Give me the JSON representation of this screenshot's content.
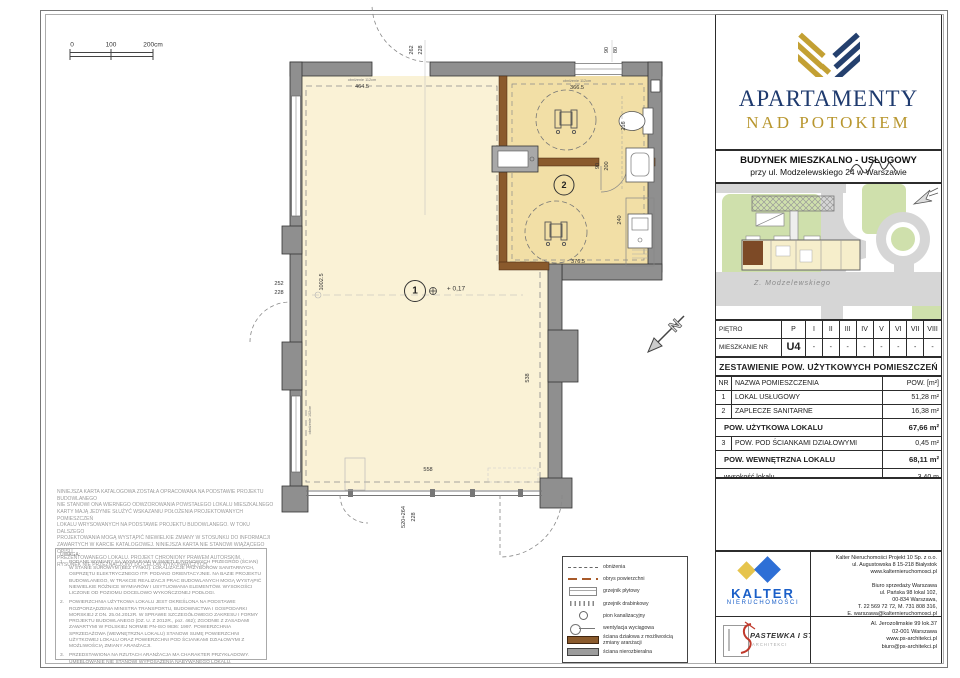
{
  "brand": {
    "line1": "APARTAMENTY",
    "line2": "NAD POTOKIEM"
  },
  "building": {
    "line1": "BUDYNEK MIESZKALNO - USŁUGOWY",
    "line2": "przy ul. Modzelewskiego 24 w Warszawie"
  },
  "site_map": {
    "street": "Z. Modzelewskiego"
  },
  "floor_table": {
    "row1_label": "PIĘTRO",
    "row2_label": "MIESZKANIE NR",
    "cols": [
      "P",
      "I",
      "II",
      "III",
      "IV",
      "V",
      "VI",
      "VII",
      "VIII"
    ],
    "vals": [
      "U4",
      "-",
      "-",
      "-",
      "-",
      "-",
      "-",
      "-",
      "-"
    ]
  },
  "area_table": {
    "title": "ZESTAWIENIE POW. UŻYTKOWYCH POMIESZCZEŃ",
    "col_nr": "NR",
    "col_name": "NAZWA POMIESZCZENIA",
    "col_area": "POW. [m²]",
    "rows": [
      {
        "nr": "1",
        "name": "LOKAL USŁUGOWY",
        "area": "51,28 m²"
      },
      {
        "nr": "2",
        "name": "ZAPLECZE SANITARNE",
        "area": "16,38 m²"
      }
    ],
    "sum1_label": "POW. UŻYTKOWA LOKALU",
    "sum1_value": "67,66 m²",
    "row3": {
      "nr": "3",
      "name": "POW. POD ŚCIANKAMI DZIAŁOWYMI",
      "area": "0,45 m²"
    },
    "sum2_label": "POW. WEWNĘTRZNA LOKALU",
    "sum2_value": "68,11 m²",
    "height_label": "wysokość  lokalu",
    "height_value": "3,40 m"
  },
  "plan": {
    "scale": {
      "s0": "0",
      "s100": "100",
      "s200": "200cm"
    },
    "room1": {
      "number": "1",
      "level": "+ 0,17"
    },
    "room2": {
      "number": "2"
    },
    "north": "N",
    "dims": {
      "t464": "464.5",
      "t366": "366.5",
      "ob112a": "obniżenie 112cm",
      "ob112b": "obniżenie 112cm",
      "ob102": "obniżenie 102cm",
      "d262": "262",
      "d228a": "228",
      "d90a": "90",
      "d80": "80",
      "l252": "252",
      "l228": "228",
      "v1002": "1002.5",
      "v538": "538",
      "d376": "376.5",
      "d216": "216",
      "d240": "240",
      "d90b": "90",
      "d200": "200",
      "b558": "558",
      "b520": "520+264",
      "b228": "228"
    }
  },
  "legend": {
    "items": [
      {
        "symbol": "dashed-gray-line",
        "label": "obniżenia"
      },
      {
        "symbol": "dashed-red-line",
        "label": "obrys powierzchni"
      },
      {
        "symbol": "panel-radiator",
        "label": "grzejnik płytowy"
      },
      {
        "symbol": "ladder-radiator",
        "label": "grzejnik drabinkowy"
      },
      {
        "symbol": "circle",
        "label": "pion kanalizacyjny"
      },
      {
        "symbol": "vent",
        "label": "wentylacja wyciągowa"
      },
      {
        "symbol": "brown-bar",
        "label": "ściana działowa z możliwością zmiany aranżacji"
      },
      {
        "symbol": "gray-bar",
        "label": "ściana nierozbieralna"
      }
    ]
  },
  "kalter": {
    "name": "KALTER",
    "subtitle": "NIERUCHOMOŚCI"
  },
  "architect": {
    "name": "PASTEWKA I STRÓJ",
    "subtitle": "ARCHITEKCI"
  },
  "contacts": {
    "kalter_hq": "Kalter Nieruchomości Projekt 10 Sp. z o.o.\nul. Augustowska 8 15-218 Białystok\nwww.kalternieruchomosci.pl",
    "kalter_office": "Biuro sprzedaży Warszawa\nul. Pańska 98 lokal 102,\n00-834 Warszawa,\nT. 22 569 72 72, M. 731 808 316,\nE. warszawa@kalternieruchomosci.pl",
    "architect_office": "Al. Jerozolimskie 99 lok.37\n02-001 Warszawa\nwww.ps-architekci.pl\nbiuro@ps-architekci.pl"
  },
  "disclaimer": "NINIEJSZA KARTA KATALOGOWA ZOSTAŁA OPRACOWANA NA PODSTAWIE PROJEKTU BUDOWLANEGO\nNIE STANOWI ONA WIERNEGO ODWZOROWANIA POWSTAŁEGO LOKALU MIESZKALNEGO\nKARTY MAJĄ JEDYNIE SŁUŻYĆ WSKAZANIU POŁOŻENIA PROJEKTOWANYCH POMIESZCZEŃ\nLOKALU WRYSOWANYCH NA PODSTAWIE PROJEKTU BUDOWLANEGO. W TOKU DALSZEGO\nPROJEKTOWANIA MOGĄ WYSTĄPIĆ NIEWIELKIE ZMIANY W STOSUNKU DO INFORMACJI\nZAWARTYCH W KARCIE KATALOGOWEJ. NINIEJSZA KARTA NIE STANOWI WIĄŻĄCEGO OPISU\nPREZENTOWANEGO LOKALU. PROJEKT CHRONIONY PRAWEM AUTORSKIM.\nRYSUNEK NIE PRZEZNACZONY DO CELÓW WYKONAWCZYCH.",
  "uwagi": {
    "title": "UWAGA:",
    "items": [
      {
        "num": "1.",
        "text": "PODANE WYMIARY SĄ WYMIARAMI W ŚWIETLE PIONOWYCH PRZEGRÓD (ŚCIAN) W STANIE SUROWYM (BEZ TYNKU). LOKALIZACJE PRZYBORÓW SANITARNYCH, OSPRZĘTU ELEKTRYCZNEGO ITP. PODANO ORIENTACYJNIE. NA BAZIE PROJEKTU BUDOWLANEGO, W TRAKCIE REALIZACJI PRAC BUDOWLANYCH MOGĄ WYSTĄPIĆ NIEWIELKIE RÓŻNICE WYMIARÓW I USYTUOWANIA ELEMENTÓW. WYSOKOŚCI LICZONE OD POZIOMU DOCELOWO WYKOŃCZONEJ PODŁOGI."
      },
      {
        "num": "2.",
        "text": "POWIERZCHNIA UŻYTKOWA LOKALU JEST OKREŚLONA NA PODSTAWIE ROZPORZĄDZENIA MINISTRA TRANSPORTU, BUDOWNICTWA I GOSPODARKI MORSKIEJ Z DN. 25.04.2012R. W SPRAWIE SZCZEGÓŁOWEGO ZAKRESU I FORMY PROJEKTU BUDOWLANEGO (DZ. U. Z 2012R., poz. 462); ZGODNIE Z ZASADAMI ZAWARTYMI W POLSKIEJ NORMIE PN-ISO 9836: 1997. POWIERZCHNIA SPRZEDAŻOWA (WEWNĘTRZNA LOKALU) STANOWI SUMĘ POWIERZCHNI UŻYTKOWEJ LOKALU ORAZ POWIERZCHNI POD ŚCIANKAMI DZIAŁOWYMI Z MOŻLIWOŚCIĄ ZMIANY ARANŻACJI."
      },
      {
        "num": "3.",
        "text": "PRZEDSTAWIONA NA RZUTACH ARANŻACJA MA CHARAKTER PRZYKŁADOWY. UMEBLOWANIE NIE STANOWI WYPOSAŻENIA NABYWANEGO LOKALU."
      }
    ]
  },
  "colors": {
    "navy": "#1e3a6e",
    "gold": "#b8962e",
    "kalter_blue": "#1a5fc8",
    "room1_fill": "#faf2d6",
    "room2_fill": "#f2dfa6",
    "wall": "#8f8f8f",
    "partition_brown": "#8a5a2c",
    "map_green": "#cfe0ac",
    "map_road": "#d6d6d6",
    "unit_highlight": "#7d4a26",
    "signature_red": "#c0392b"
  }
}
